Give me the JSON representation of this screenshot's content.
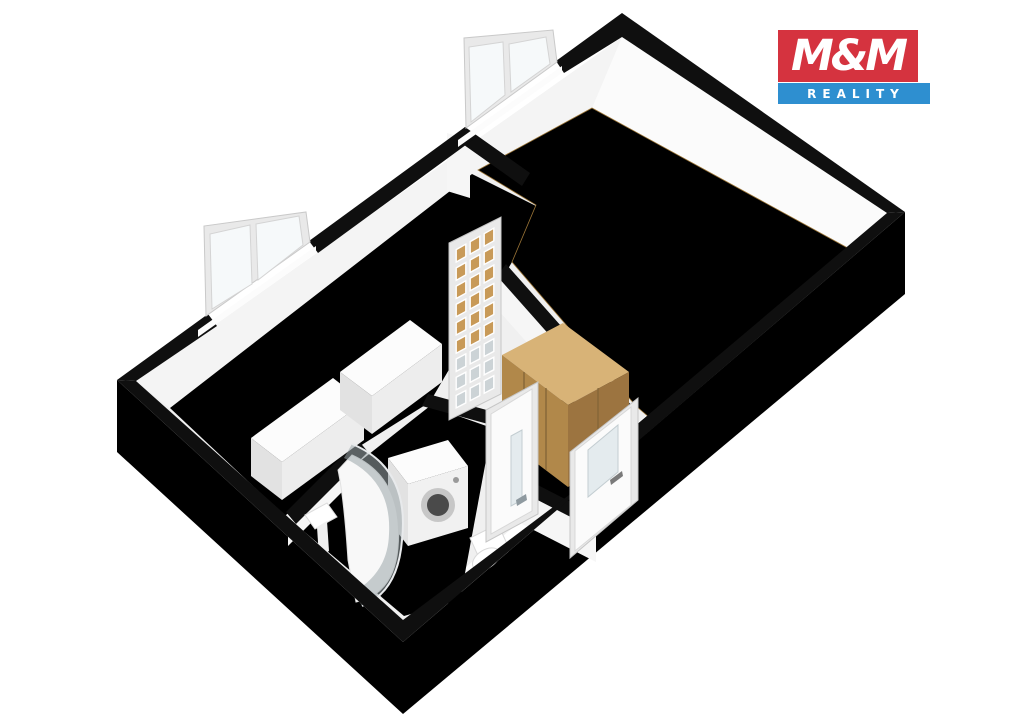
{
  "logo": {
    "title": "M&M",
    "subtitle": "REALITY",
    "red": "#d5333f",
    "blue": "#2e8fd0"
  },
  "palette": {
    "wallCut": "#0f0f0f",
    "baseFloor": "#f0f0f0",
    "outerSE": "url:seGrad",
    "outerSW": "url:swGrad",
    "faceNW": "#f4f4f4",
    "faceNE": "#fbfbfb",
    "faceInt": "#f6f6f6",
    "leftFloor": "url:leftFloorGrad",
    "parquet": "url:parquetPat",
    "tile": "url:tilePat",
    "furnWhiteTop": "#fcfcfc",
    "furnWhiteFront": "#ededed",
    "furnWhiteSide": "#e2e2e2",
    "washFront": "#f1f1f1",
    "washRing": "#c7c7c7",
    "washDrum": "#4a4a4a",
    "wardTop": "#d8b377",
    "wardFront": "#b1884a",
    "wardSide": "#9c7440",
    "wardSeam": "#7d6135",
    "white": "#ffffff",
    "doorFrame": "#e9e9e9",
    "doorLeaf": "#fbfbfb",
    "doorEdge": "#cccccc",
    "frosted": "#e4ebee",
    "glassAmber": "#c89a58",
    "glassGray": "#ccd3d6",
    "windowGlass": "#f6f9fa",
    "glass": "#9ba5aa",
    "handle": "#8f9aa0"
  },
  "floorplan": {
    "rooms": [
      "main-room-parquet",
      "left-room",
      "bathroom",
      "hallway"
    ],
    "fixtures": [
      "wardrobe",
      "kitchen-cabinets",
      "washing-machine",
      "shower-enclosure",
      "toilet",
      "washbasin"
    ],
    "openings": [
      "window-main-room",
      "window-left-room",
      "glazed-french-door",
      "bathroom-door",
      "entrance-door"
    ],
    "shapes": [
      {
        "n": "floor-base",
        "k": "poly",
        "p": "622,37 887,213 403,620 136,381",
        "f": "baseFloor"
      },
      {
        "n": "outer-wall-face-se",
        "k": "poly",
        "p": "905,212 403,642 403,714 905,294",
        "f": "outerSE"
      },
      {
        "n": "outer-wall-face-sw",
        "k": "poly",
        "p": "117,380 403,642 403,714 117,452",
        "f": "outerSW"
      },
      {
        "n": "wall-face-nw",
        "k": "poly",
        "p": "622,37 136,381 170,408 480,172 592,108",
        "f": "faceNW"
      },
      {
        "n": "wall-face-ne",
        "k": "poly",
        "p": "622,37 887,213 855,252 592,108",
        "f": "faceNE"
      },
      {
        "n": "wall-face-se-inner",
        "k": "poly",
        "p": "887,213 626,434 650,418 855,252",
        "f": "faceNE"
      },
      {
        "n": "floor-left-room",
        "k": "poly",
        "p": "472,174 170,408 285,516 360,446 430,402 512,262 536,206",
        "f": "leftFloor"
      },
      {
        "n": "floor-main-room-parquet",
        "k": "poly",
        "p": "592,108 855,252 650,418 636,406 512,262 536,205 478,170",
        "f": "parquet",
        "s": "#9a7436",
        "w": 0.8
      },
      {
        "n": "floor-bathroom",
        "k": "poly",
        "p": "288,518 430,406 492,428 460,600 404,616",
        "f": "tile"
      },
      {
        "n": "floor-hallway",
        "k": "poly",
        "p": "544,398 628,408 651,441 602,518 528,482 498,448",
        "f": "tile"
      },
      {
        "n": "wall-a-face",
        "k": "poly",
        "p": "491,266 624,416 624,452 491,302",
        "f": "faceInt"
      },
      {
        "n": "wall-hall-south-face",
        "k": "poly",
        "p": "522,491 596,529 596,562 522,524",
        "f": "faceInt"
      },
      {
        "n": "wall-bath-west-face",
        "k": "poly",
        "p": "288,514 360,442 360,474 288,546",
        "f": "faceInt"
      },
      {
        "n": "wall-stub-end-face",
        "k": "poly",
        "p": "447,133 470,140 470,198 447,191",
        "f": "faceInt"
      },
      {
        "n": "wall-a-end-face",
        "k": "poly",
        "p": "624,416 636,407 636,448 624,457",
        "f": "faceInt"
      },
      {
        "n": "wall-stub-top",
        "k": "poly",
        "p": "465,127 530,173 522,186 457,140",
        "f": "wallCut"
      },
      {
        "n": "wall-a-top",
        "k": "poly",
        "p": "506,264 632,406 623,418 497,276",
        "f": "wallCut"
      },
      {
        "n": "wall-bath-north-top",
        "k": "poly",
        "p": "428,394 494,412 488,424 422,406",
        "f": "wallCut"
      },
      {
        "n": "wall-bath-west-top",
        "k": "poly",
        "p": "358,440 286,512 296,524 368,452",
        "f": "wallCut"
      },
      {
        "n": "wall-hall-south-top",
        "k": "poly",
        "p": "528,480 602,518 596,530 522,492",
        "f": "wallCut"
      },
      {
        "n": "cabinet-1-top",
        "k": "poly",
        "p": "251,438 333,378 364,402 282,462",
        "f": "furnWhiteTop"
      },
      {
        "n": "cabinet-1-front",
        "k": "poly",
        "p": "282,462 364,402 364,440 282,500",
        "f": "furnWhiteFront"
      },
      {
        "n": "cabinet-1-side",
        "k": "poly",
        "p": "251,438 282,462 282,500 251,476",
        "f": "furnWhiteSide"
      },
      {
        "n": "cabinet-2-top",
        "k": "poly",
        "p": "340,372 410,320 442,344 372,396",
        "f": "furnWhiteTop"
      },
      {
        "n": "cabinet-2-front",
        "k": "poly",
        "p": "372,396 442,344 442,382 372,434",
        "f": "furnWhiteFront"
      },
      {
        "n": "cabinet-2-side",
        "k": "poly",
        "p": "340,372 372,396 372,434 340,410",
        "f": "furnWhiteSide"
      },
      {
        "n": "wardrobe-top",
        "k": "poly",
        "p": "502,355 563,323 629,372 568,405",
        "f": "wardTop"
      },
      {
        "n": "wardrobe-front",
        "k": "poly",
        "p": "502,355 568,405 568,487 502,437",
        "f": "wardFront"
      },
      {
        "n": "wardrobe-side",
        "k": "poly",
        "p": "568,405 629,372 629,452 568,487",
        "f": "wardSide"
      },
      {
        "n": "wardrobe-seam-1",
        "k": "line",
        "a": "524,372",
        "b": "524,454",
        "s": "wardSeam",
        "w": 1.2
      },
      {
        "n": "wardrobe-seam-2",
        "k": "line",
        "a": "546,388",
        "b": "546,470",
        "s": "wardSeam",
        "w": 1.2
      },
      {
        "n": "wardrobe-side-seam",
        "k": "line",
        "a": "598,388",
        "b": "598,468",
        "s": "wardSeam",
        "w": 1
      },
      {
        "n": "washing-machine-top",
        "k": "poly",
        "p": "388,458 448,440 468,466 408,484",
        "f": "furnWhiteTop"
      },
      {
        "n": "washing-machine-front",
        "k": "poly",
        "p": "408,484 468,466 468,528 408,546",
        "f": "washFront"
      },
      {
        "n": "washing-machine-side",
        "k": "poly",
        "p": "388,458 408,484 408,546 388,520",
        "f": "furnWhiteSide"
      },
      {
        "n": "washing-machine-door",
        "k": "circle",
        "cx": 438,
        "cy": 505,
        "r": 17,
        "f": "washRing"
      },
      {
        "n": "washing-machine-drum",
        "k": "circle",
        "cx": 438,
        "cy": 505,
        "r": 11,
        "f": "washDrum"
      },
      {
        "n": "washing-machine-knob",
        "k": "circle",
        "cx": 456,
        "cy": 480,
        "r": 3,
        "f": "#9a9a9a"
      },
      {
        "n": "toilet-tank",
        "k": "poly",
        "p": "470,538 498,524 508,546 480,560",
        "f": "white",
        "s": "#d9d9d9",
        "w": 1
      },
      {
        "n": "toilet-bowl",
        "k": "ellipse",
        "cx": 486,
        "cy": 559,
        "rx": 15,
        "ry": 9,
        "rot": -33,
        "f": "white",
        "s": "#d9d9d9",
        "w": 1
      },
      {
        "n": "washbasin",
        "k": "poly",
        "p": "305,515 327,503 337,517 315,529",
        "f": "white",
        "s": "#dcdcdc",
        "w": 1
      },
      {
        "n": "washbasin-pedestal",
        "k": "poly",
        "p": "317,527 327,521 329,551 319,557",
        "f": "#efefef"
      },
      {
        "n": "shower-tray",
        "k": "path",
        "d": "M352,455 Q404,478 398,548 Q394,594 356,602 L348,560 Q344,498 338,470 Z",
        "f": "#f8f8f8",
        "s": "#e2e2e2",
        "w": 1
      },
      {
        "n": "shower-glass",
        "k": "path",
        "d": "M352,444 Q410,468 402,540 Q398,592 362,606 L354,592 Q388,572 389,534 Q392,480 344,458 Z",
        "f": "glass",
        "o": 0.55
      },
      {
        "n": "shower-glass-edge",
        "k": "path",
        "d": "M352,444 Q410,468 402,540 Q398,592 362,606",
        "f": "none",
        "s": "#e8eaec",
        "w": 2
      },
      {
        "n": "wall-ne-top",
        "k": "poly",
        "p": "622,13 905,212 887,213 622,37",
        "f": "wallCut"
      },
      {
        "n": "wall-nw-top-1",
        "k": "poly",
        "p": "622,13 556,61 564,73 622,37",
        "f": "wallCut"
      },
      {
        "n": "wall-nw-top-2",
        "k": "poly",
        "p": "465,127 309,241 318,253 474,139",
        "f": "wallCut"
      },
      {
        "n": "wall-nw-top-3",
        "k": "poly",
        "p": "208,314 117,380 136,381 217,326",
        "f": "wallCut"
      },
      {
        "n": "wall-se-top-1",
        "k": "poly",
        "p": "905,212 631,447 622,437 887,213",
        "f": "wallCut"
      },
      {
        "n": "wall-se-top-2",
        "k": "poly",
        "p": "585,486 403,642 403,620 593,477",
        "f": "wallCut"
      },
      {
        "n": "wall-sw-top",
        "k": "poly",
        "p": "117,380 403,642 403,620 136,381",
        "f": "wallCut"
      },
      {
        "n": "window-main-sill",
        "k": "poly",
        "p": "562,66 458,140 458,147 562,73",
        "f": "#fcfcfc"
      },
      {
        "n": "window-main-frame",
        "k": "poly",
        "p": "557,62 466,128 464,38 553,30",
        "f": "doorFrame",
        "s": "#c9c9c9",
        "w": 1
      },
      {
        "n": "window-main-glass-1",
        "k": "poly",
        "p": "505,95 471,122 469,47 503,42",
        "f": "windowGlass",
        "s": "#d4d4d4",
        "w": 1
      },
      {
        "n": "window-main-glass-2",
        "k": "poly",
        "p": "550,64 511,92 509,44 546,37",
        "f": "windowGlass",
        "s": "#d4d4d4",
        "w": 1
      },
      {
        "n": "window-left-sill",
        "k": "poly",
        "p": "316,246 198,330 198,337 316,253",
        "f": "#fcfcfc"
      },
      {
        "n": "window-left-frame",
        "k": "poly",
        "p": "310,242 206,316 204,226 306,212",
        "f": "doorFrame",
        "s": "#c9c9c9",
        "w": 1
      },
      {
        "n": "window-left-glass-1",
        "k": "poly",
        "p": "252,284 212,309 210,234 250,225",
        "f": "windowGlass",
        "s": "#d4d4d4",
        "w": 1
      },
      {
        "n": "window-left-glass-2",
        "k": "poly",
        "p": "303,245 258,280 256,224 299,216",
        "f": "windowGlass",
        "s": "#d4d4d4",
        "w": 1
      },
      {
        "n": "glazed-door-frame",
        "k": "poly",
        "p": "449,243 501,217 501,394 449,420",
        "f": "doorFrame",
        "s": "#c6c6c6",
        "w": 1
      },
      {
        "n": "glazed-door-panes",
        "k": "grid",
        "q": "454,248 496,224 496,390 454,412",
        "cols": 3,
        "rows": 9,
        "amberRows": 6,
        "inset": 0.16
      },
      {
        "n": "bathroom-door-frame",
        "k": "poly",
        "p": "486,410 538,382 538,514 486,542",
        "f": "doorFrame",
        "s": "#c6c6c6",
        "w": 1
      },
      {
        "n": "bathroom-door-leaf",
        "k": "poly",
        "p": "491,414 532,389 532,511 491,534",
        "f": "doorLeaf",
        "s": "#d8d8d8",
        "w": 1
      },
      {
        "n": "bathroom-door-pane",
        "k": "poly",
        "p": "511,436 522,430 522,500 511,506",
        "f": "frosted",
        "s": "#c3cdd1",
        "w": 1
      },
      {
        "n": "bathroom-door-handle",
        "k": "poly",
        "p": "516,500 526,494 527,500 517,506",
        "f": "handle"
      },
      {
        "n": "entrance-door-frame",
        "k": "poly",
        "p": "570,452 638,398 638,500 570,558",
        "f": "doorFrame",
        "s": "#c6c6c6",
        "w": 1
      },
      {
        "n": "entrance-door-leaf",
        "k": "poly",
        "p": "575,451 631,407 631,505 575,551",
        "f": "doorLeaf",
        "s": "#d8d8d8",
        "w": 1
      },
      {
        "n": "entrance-door-pane",
        "k": "poly",
        "p": "588,450 618,425 618,472 588,497",
        "f": "frosted",
        "s": "#c3cdd1",
        "w": 1
      },
      {
        "n": "entrance-door-handle",
        "k": "poly",
        "p": "610,480 622,471 623,476 611,485",
        "f": "#7a7a7a"
      }
    ]
  }
}
